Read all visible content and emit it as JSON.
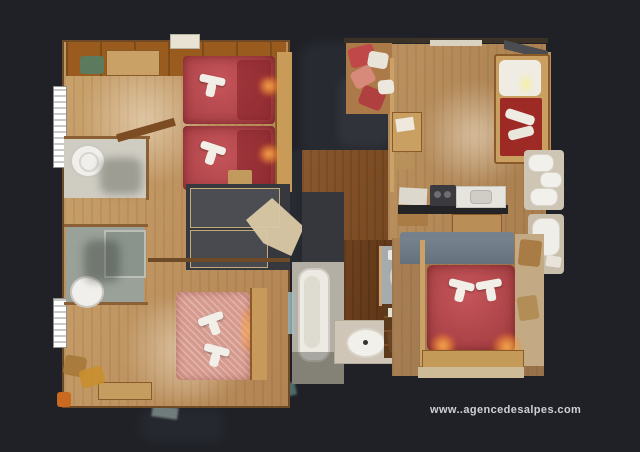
{
  "watermark": {
    "text": "www..agencedesalpes.com"
  },
  "palette": {
    "background": "#1f2127",
    "wood_floor_light": "#cfa873",
    "wood_floor_mid": "#b58a58",
    "wood_floor_dark": "#7a4c28",
    "bed_red": "#b4474b",
    "bed_pink": "#d69a8e",
    "towel": "#f2efe8",
    "bathroom_gray_green": "#99a198",
    "fixture_white": "#f0eeea",
    "dining_table_blue_gray": "#6f7d89",
    "lamp_glow_orange": "#ffb14d",
    "furniture_wood": "#b5722f"
  },
  "legend": {
    "towel-icon": "white folded towel on bed (css bars)",
    "lamp-glow-icon": "warm bedside light (radial gradient)",
    "sink-icon": "round white basin (css circle)",
    "bathtub-icon": "white tub (rounded rect)",
    "toilet-icon": "tank + bowl (css shapes)"
  }
}
